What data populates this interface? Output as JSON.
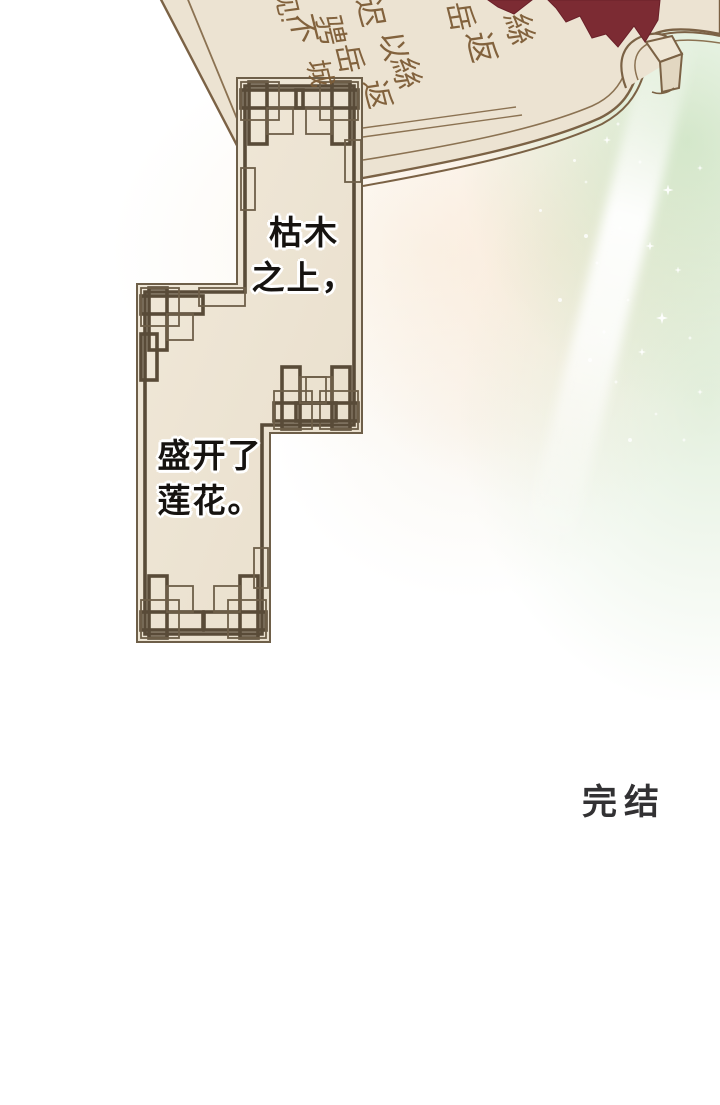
{
  "speech_bubbles": {
    "top": {
      "lines": [
        "枯木",
        "之上，"
      ]
    },
    "bottom": {
      "lines": [
        "盛开了",
        "莲花。"
      ]
    }
  },
  "ending_label": "完结",
  "book": {
    "calligraphy_glyphs": [
      {
        "text": "见!"
      },
      {
        "text": "不"
      },
      {
        "text": "骋"
      },
      {
        "text": "迟"
      },
      {
        "text": "以"
      },
      {
        "text": "岳"
      },
      {
        "text": "城"
      },
      {
        "text": "絲"
      },
      {
        "text": "返"
      },
      {
        "text": "岳"
      },
      {
        "text": "返"
      },
      {
        "text": "絲"
      }
    ]
  },
  "colors": {
    "page_background": "#ffffff",
    "book_page_fill": "#ece3d2",
    "book_outline": "#7b6245",
    "calligraphy_ink": "#7d5c36",
    "panel_fill": "#ece2d1",
    "frame_thin_line": "#6e5f49",
    "frame_thick_line": "#594b38",
    "red_leaf": "#7c2b33",
    "speech_text": "#161310",
    "speech_halo": "#ffffff",
    "ending_text": "#323133",
    "green_wash": "#cbe4c3",
    "peach_wash": "#fadec6"
  }
}
